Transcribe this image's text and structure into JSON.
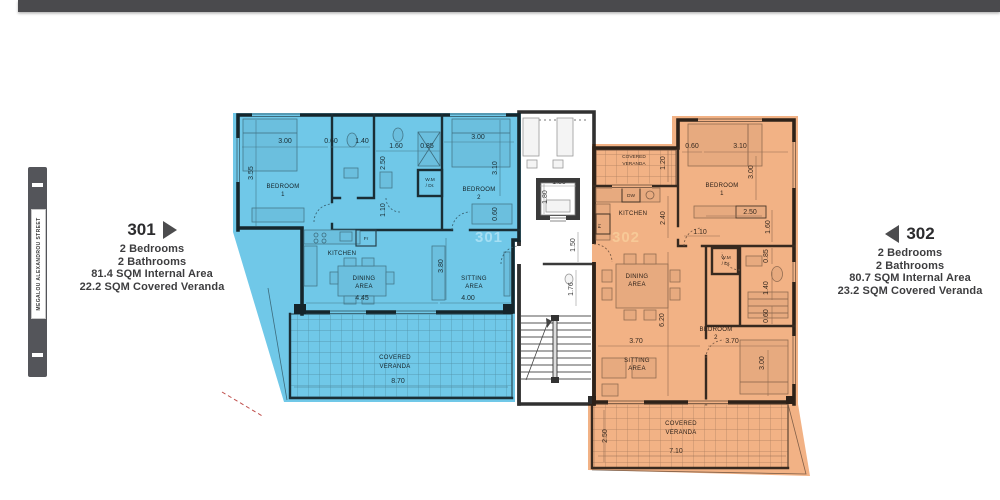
{
  "street_sign": {
    "name": "MEGALOU ALEXANDROU STREET"
  },
  "apartments": [
    {
      "id": "301",
      "number": "301",
      "arrow": "right",
      "lines": [
        "2 Bedrooms",
        "2 Bathrooms",
        "81.4 SQM Internal Area",
        "22.2 SQM Covered Veranda"
      ],
      "accent": "#70c8e8"
    },
    {
      "id": "302",
      "number": "302",
      "arrow": "left",
      "lines": [
        "2 Bedrooms",
        "2 Bathrooms",
        "80.7 SQM Internal Area",
        "23.2 SQM Covered Veranda"
      ],
      "accent": "#f2b285"
    }
  ],
  "floorplan": {
    "overlay_colors": {
      "unit_301": "#70c8e8",
      "unit_302": "#f2b285"
    },
    "texts": [
      {
        "t": "3.00",
        "x": 285,
        "y": 143
      },
      {
        "t": "0.60",
        "x": 331,
        "y": 143
      },
      {
        "t": "1.40",
        "x": 362,
        "y": 143
      },
      {
        "t": "1.60",
        "x": 396,
        "y": 148
      },
      {
        "t": "0.85",
        "x": 427,
        "y": 148
      },
      {
        "t": "3.00",
        "x": 478,
        "y": 139
      },
      {
        "t": "3.55",
        "x": 253,
        "y": 173,
        "r": -90
      },
      {
        "t": "2.50",
        "x": 385,
        "y": 163,
        "r": -90
      },
      {
        "t": "3.10",
        "x": 497,
        "y": 168,
        "r": -90
      },
      {
        "t": "1.10",
        "x": 385,
        "y": 210,
        "r": -90
      },
      {
        "t": "0.60",
        "x": 497,
        "y": 214,
        "r": -90
      },
      {
        "t": "3.80",
        "x": 443,
        "y": 266,
        "r": -90
      },
      {
        "t": "4.45",
        "x": 362,
        "y": 300
      },
      {
        "t": "4.00",
        "x": 468,
        "y": 300
      },
      {
        "t": "8.70",
        "x": 398,
        "y": 383
      },
      {
        "t": "BEDROOM",
        "x": 283,
        "y": 188,
        "c": "room"
      },
      {
        "t": "1",
        "x": 283,
        "y": 196,
        "c": "room"
      },
      {
        "t": "BEDROOM",
        "x": 479,
        "y": 191,
        "c": "room"
      },
      {
        "t": "2",
        "x": 479,
        "y": 199,
        "c": "room"
      },
      {
        "t": "KITCHEN",
        "x": 342,
        "y": 255,
        "c": "room"
      },
      {
        "t": "DINING",
        "x": 364,
        "y": 280,
        "c": "room"
      },
      {
        "t": "AREA",
        "x": 364,
        "y": 288,
        "c": "room"
      },
      {
        "t": "SITTING",
        "x": 474,
        "y": 280,
        "c": "room"
      },
      {
        "t": "AREA",
        "x": 474,
        "y": 288,
        "c": "room"
      },
      {
        "t": "COVERED",
        "x": 395,
        "y": 359,
        "c": "room"
      },
      {
        "t": "VERANDA",
        "x": 395,
        "y": 368,
        "c": "room"
      },
      {
        "t": "Fr",
        "x": 366,
        "y": 240,
        "c": "tiny"
      },
      {
        "t": "W.M",
        "x": 430,
        "y": 181,
        "c": "tiny"
      },
      {
        "t": "/ Dr.",
        "x": 430,
        "y": 187,
        "c": "tiny"
      },
      {
        "t": "1.80",
        "x": 559,
        "y": 184
      },
      {
        "t": "1.80",
        "x": 547,
        "y": 197,
        "r": -90
      },
      {
        "t": "1.50",
        "x": 575,
        "y": 245,
        "r": -90
      },
      {
        "t": "1.76",
        "x": 573,
        "y": 289,
        "r": -90
      },
      {
        "t": "COVERED",
        "x": 634,
        "y": 158,
        "c": "tiny"
      },
      {
        "t": "VERANDA",
        "x": 634,
        "y": 165,
        "c": "tiny"
      },
      {
        "t": "1.20",
        "x": 665,
        "y": 163,
        "r": -90
      },
      {
        "t": "0.60",
        "x": 692,
        "y": 148
      },
      {
        "t": "3.10",
        "x": 740,
        "y": 148
      },
      {
        "t": "3.00",
        "x": 753,
        "y": 172,
        "r": -90
      },
      {
        "t": "BEDROOM",
        "x": 722,
        "y": 187,
        "c": "room"
      },
      {
        "t": "1",
        "x": 722,
        "y": 195,
        "c": "room"
      },
      {
        "t": "KITCHEN",
        "x": 633,
        "y": 215,
        "c": "room"
      },
      {
        "t": "DW",
        "x": 631,
        "y": 197,
        "c": "tiny"
      },
      {
        "t": "Fr",
        "x": 601,
        "y": 226,
        "c": "tiny",
        "r": -90
      },
      {
        "t": "2.40",
        "x": 665,
        "y": 218,
        "r": -90
      },
      {
        "t": "2.50",
        "x": 750,
        "y": 214
      },
      {
        "t": "1.10",
        "x": 700,
        "y": 234
      },
      {
        "t": "1.60",
        "x": 770,
        "y": 227,
        "r": -90
      },
      {
        "t": "W.M",
        "x": 726,
        "y": 259,
        "c": "tiny"
      },
      {
        "t": "/ Dr.",
        "x": 726,
        "y": 265,
        "c": "tiny"
      },
      {
        "t": "0.85",
        "x": 768,
        "y": 256,
        "r": -90
      },
      {
        "t": "1.40",
        "x": 768,
        "y": 288,
        "r": -90
      },
      {
        "t": "0.60",
        "x": 768,
        "y": 316,
        "r": -90
      },
      {
        "t": "6.20",
        "x": 664,
        "y": 320,
        "r": -90
      },
      {
        "t": "DINING",
        "x": 637,
        "y": 278,
        "c": "room"
      },
      {
        "t": "AREA",
        "x": 637,
        "y": 286,
        "c": "room"
      },
      {
        "t": "BEDROOM",
        "x": 716,
        "y": 331,
        "c": "room"
      },
      {
        "t": "2",
        "x": 716,
        "y": 339,
        "c": "room"
      },
      {
        "t": "3.70",
        "x": 636,
        "y": 343
      },
      {
        "t": "3.70",
        "x": 732,
        "y": 343
      },
      {
        "t": "SITTING",
        "x": 637,
        "y": 362,
        "c": "room"
      },
      {
        "t": "AREA",
        "x": 637,
        "y": 370,
        "c": "room"
      },
      {
        "t": "3.00",
        "x": 764,
        "y": 363,
        "r": -90
      },
      {
        "t": "COVERED",
        "x": 681,
        "y": 425,
        "c": "room"
      },
      {
        "t": "VERANDA",
        "x": 681,
        "y": 434,
        "c": "room"
      },
      {
        "t": "2.50",
        "x": 607,
        "y": 436,
        "r": -90
      },
      {
        "t": "7.10",
        "x": 676,
        "y": 453
      }
    ],
    "watermarks": [
      {
        "t": "301",
        "x": 489,
        "y": 242,
        "c": "wm301"
      },
      {
        "t": "302",
        "x": 626,
        "y": 242,
        "c": "wm302"
      }
    ]
  }
}
